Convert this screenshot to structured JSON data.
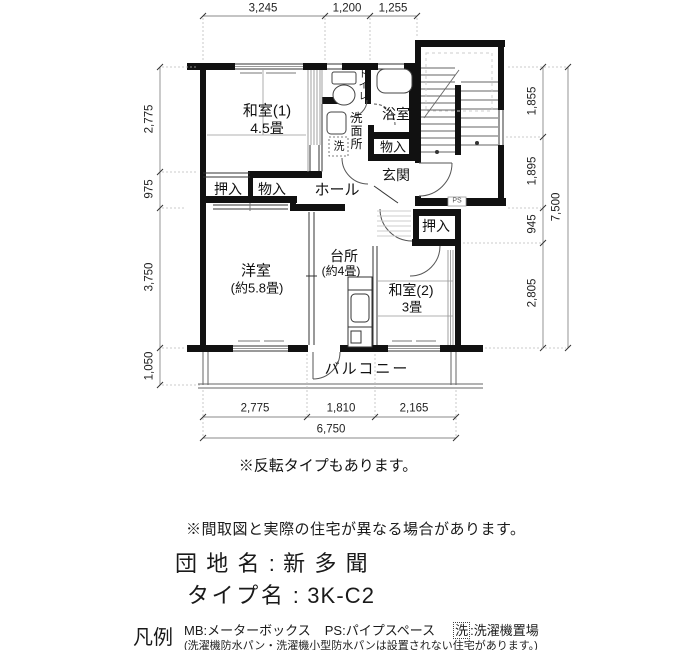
{
  "plan": {
    "dimensions": {
      "top": [
        "3,245",
        "1,200",
        "1,255"
      ],
      "left": [
        "2,775",
        "975",
        "3,750",
        "1,050"
      ],
      "right": [
        "1,855",
        "1,895",
        "945",
        "2,805"
      ],
      "right_total": "7,500",
      "bottom": [
        "2,775",
        "1,810",
        "2,165"
      ],
      "bottom_total": "6,750"
    },
    "rooms": {
      "washitsu1": {
        "name": "和室(1)",
        "size": "4.5畳"
      },
      "yoshitsu": {
        "name": "洋室",
        "size": "(約5.8畳)"
      },
      "daidokoro": {
        "name": "台所",
        "size": "(約4畳)"
      },
      "washitsu2": {
        "name": "和室(2)",
        "size": "3畳"
      },
      "hall": "ホール",
      "genkan": "玄関",
      "yokushitsu": "浴室",
      "senmenjo": "洗面所",
      "toilet": "トイレ",
      "oshiire_left": "押入",
      "monoiire_left": "物入",
      "monoiire_upper": "物入",
      "oshiire_right": "押入",
      "balcony": "バルコニー",
      "laundry": "洗",
      "ps": "PS"
    }
  },
  "notes": {
    "reverse": "※反転タイプもあります。",
    "disclaimer": "※間取図と実際の住宅が異なる場合があります。"
  },
  "info": {
    "danchi_label": "団地名",
    "colon": ":",
    "danchi_value": "新多聞",
    "type_label": "タイプ名",
    "type_value": "3K-C2"
  },
  "legend": {
    "title": "凡例",
    "mb": "MB:メーターボックス",
    "ps": "PS:パイプスペース",
    "sen_box": "洗",
    "sen_rest": ":洗濯機置場",
    "note": "(洗濯機防水パン・洗濯機小型防水パンは設置されない住宅があります。)"
  }
}
